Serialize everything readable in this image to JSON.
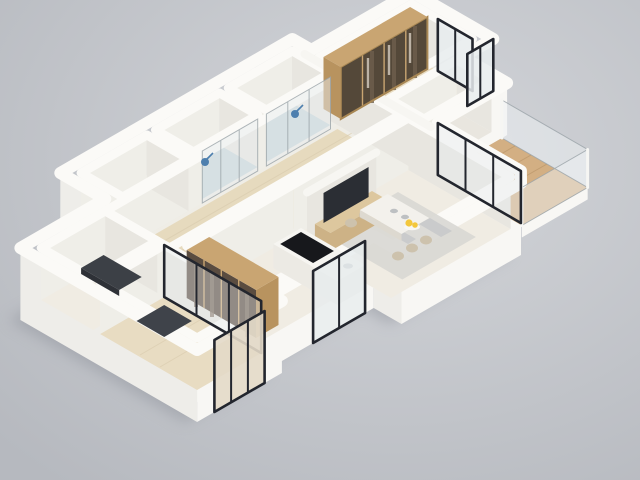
{
  "scene": {
    "type": "isometric-3d-floor-plan-render",
    "description": "3D dollhouse cutaway render of an apartment with white walls floating on a neutral gray studio background",
    "view_angle": "isometric from upper right"
  },
  "palette": {
    "bg_light": "#d4d6da",
    "bg_dark": "#b6b9bf",
    "shadow": "#8f939b",
    "slab": "#efede6",
    "wall_top": "#fbfaf7",
    "wall_bright": "#f8f7f4",
    "wall_shaded": "#eeede9",
    "wall_int_se": "#efeee8",
    "wall_int_sw": "#e8e6e0",
    "floor_wood": "#e8dcc2",
    "floor_wood2": "#e6dabe",
    "floor_light": "#f0ece3",
    "floor_bare": "#e9e6df",
    "floor_bath": "#c5d4d9",
    "balcony_wood": "#d3af83",
    "wardrobe_wood": "#c9a572",
    "wardrobe_wood_side": "#b8935f",
    "wardrobe_glass": "#544839",
    "pantry_glass": "#5a4c40",
    "frame_black": "#23262e",
    "glass_tint": "#e7ecee",
    "railing_glass": "#eef2f4",
    "rug": "#d9d8d4",
    "rug_pattern": "#b4b8bf",
    "rug_dark": "#3f434a",
    "desk_dark": "#3c4046",
    "tv_dark": "#2b2e34",
    "console_wood": "#ddc79e",
    "console_wood_front": "#cdb286",
    "table_top": "#f3f1ec",
    "table_side": "#ddd9d0",
    "chair_beige": "#cdc2ad",
    "island_top": "#f6f5f1",
    "island_side": "#eceae4",
    "cooktop_black": "#17181c",
    "fruit_yellow": "#f3c73c",
    "dish_white": "#f8f7f3",
    "item_gray": "#9aa0a6",
    "shower_blue": "#4d7fae",
    "clothes_light": "#cfc5b8"
  },
  "rooms": [
    {
      "id": "bedroom",
      "label": "Bedroom with glass-front wardrobe",
      "floor": "light wood"
    },
    {
      "id": "closet-nook",
      "label": "Walk-in nook",
      "floor": "light"
    },
    {
      "id": "ensuite-shower-room",
      "label": "En-suite shower room",
      "floor": "blue tile"
    },
    {
      "id": "bathroom",
      "label": "Second shower room",
      "floor": "blue tile"
    },
    {
      "id": "hallway",
      "label": "Hallway",
      "floor": "wood"
    },
    {
      "id": "storage-room",
      "label": "Empty side room",
      "floor": "bare"
    },
    {
      "id": "study",
      "label": "Study with dark desk",
      "floor": "light"
    },
    {
      "id": "bedroom-2",
      "label": "Second bedroom with dark rug",
      "floor": "wood"
    },
    {
      "id": "living-dining",
      "label": "Open living / dining room",
      "floor": "light"
    },
    {
      "id": "kitchen",
      "label": "Kitchen",
      "floor": "light"
    },
    {
      "id": "balcony",
      "label": "Balcony with glass railing",
      "floor": "wood deck"
    }
  ],
  "features": [
    "glass-front wardrobe with wood top",
    "corner window with black frame",
    "sliding glass doors to balcony",
    "glass shower partitions with wall-mounted blue shower heads",
    "TV on wood media console",
    "long dining table with six beige chairs",
    "kitchen island with black cooktop",
    "fruit bowl with yellow fruit",
    "pantry wardrobe with bronze glass doors",
    "interior glass partition to second bedroom",
    "front sliding door with black frame",
    "kitchen window with black frame"
  ]
}
